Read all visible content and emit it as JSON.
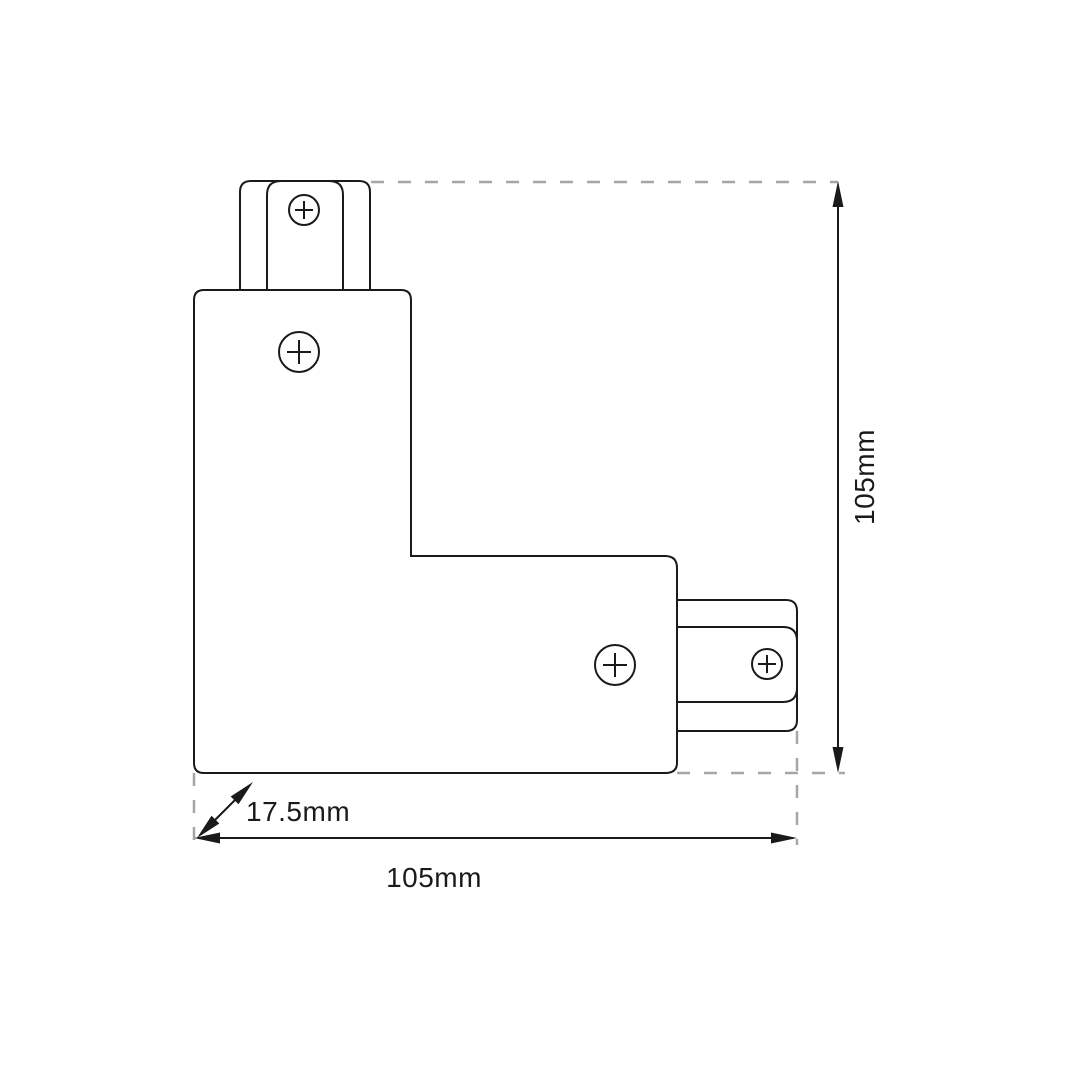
{
  "drawing_subject": "L-shaped track connector top view",
  "dimensions": {
    "height_label": "105mm",
    "width_label": "105mm",
    "depth_label": "17.5mm"
  },
  "icons": {
    "screw": "circle-plus-screw-head-icon"
  },
  "colors": {
    "line": "#1a1a1a",
    "extension": "#a6a6a6",
    "background": "#ffffff"
  }
}
